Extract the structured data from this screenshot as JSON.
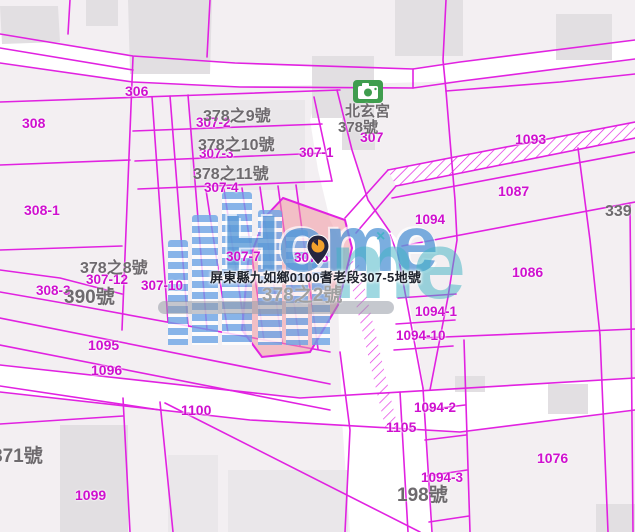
{
  "map": {
    "region_name": "九如鄉耆老段 cadastral map",
    "tooltip": {
      "text": "屏東縣九如鄉0100耆老段307-5地號"
    },
    "selected_parcel": {
      "number": "307-5",
      "fill": "#f098a2"
    },
    "parcel_labels": [
      {
        "text": "306",
        "x": 125,
        "y": 84,
        "size": 14
      },
      {
        "text": "308",
        "x": 22,
        "y": 116,
        "size": 14
      },
      {
        "text": "307-2",
        "x": 196,
        "y": 116
      },
      {
        "text": "307-3",
        "x": 199,
        "y": 147
      },
      {
        "text": "307-1",
        "x": 299,
        "y": 146
      },
      {
        "text": "307-4",
        "x": 204,
        "y": 181
      },
      {
        "text": "307",
        "x": 360,
        "y": 130,
        "size": 14
      },
      {
        "text": "308-1",
        "x": 24,
        "y": 203,
        "size": 14
      },
      {
        "text": "1093",
        "x": 515,
        "y": 132,
        "size": 14
      },
      {
        "text": "1087",
        "x": 498,
        "y": 184,
        "size": 14
      },
      {
        "text": "1094",
        "x": 415,
        "y": 213
      },
      {
        "text": "1086",
        "x": 512,
        "y": 265,
        "size": 14
      },
      {
        "text": "307-7",
        "x": 226,
        "y": 250
      },
      {
        "text": "307-5",
        "x": 294,
        "y": 251
      },
      {
        "text": "307-12",
        "x": 86,
        "y": 273
      },
      {
        "text": "308-3",
        "x": 36,
        "y": 284
      },
      {
        "text": "307-10",
        "x": 141,
        "y": 279
      },
      {
        "text": "1094-1",
        "x": 415,
        "y": 305
      },
      {
        "text": "1094-10",
        "x": 396,
        "y": 329
      },
      {
        "text": "1095",
        "x": 88,
        "y": 338,
        "size": 14
      },
      {
        "text": "1096",
        "x": 91,
        "y": 363,
        "size": 14
      },
      {
        "text": "1100",
        "x": 181,
        "y": 403,
        "size": 14
      },
      {
        "text": "1094-2",
        "x": 414,
        "y": 401
      },
      {
        "text": "1105",
        "x": 386,
        "y": 420,
        "size": 14
      },
      {
        "text": "1094-3",
        "x": 421,
        "y": 471
      },
      {
        "text": "1076",
        "x": 537,
        "y": 451,
        "size": 14
      },
      {
        "text": "1099",
        "x": 75,
        "y": 488,
        "size": 14
      }
    ],
    "address_labels": [
      {
        "text": "378之9號",
        "x": 203,
        "y": 109,
        "size": 16
      },
      {
        "text": "378之10號",
        "x": 198,
        "y": 138,
        "size": 16
      },
      {
        "text": "378之11號",
        "x": 193,
        "y": 167,
        "size": 16
      },
      {
        "text": "北玄宮",
        "x": 345,
        "y": 104,
        "size": 15
      },
      {
        "text": "378號",
        "x": 338,
        "y": 120,
        "size": 15
      },
      {
        "text": "378之8號",
        "x": 80,
        "y": 261,
        "size": 16
      },
      {
        "text": "390號",
        "x": 64,
        "y": 288,
        "size": 19
      },
      {
        "text": "378之2號",
        "x": 262,
        "y": 286,
        "size": 19,
        "color": "#a0a0a0"
      },
      {
        "text": "871號",
        "x": -8,
        "y": 447,
        "size": 19
      },
      {
        "text": "198號",
        "x": 397,
        "y": 486,
        "size": 19
      },
      {
        "text": "339",
        "x": 605,
        "y": 204,
        "size": 16
      }
    ],
    "icons": [
      {
        "name": "camera-icon",
        "meaning": "photo/temple point of interest"
      },
      {
        "name": "location-pin-icon",
        "meaning": "selected parcel marker"
      },
      {
        "name": "x-mark-icon",
        "meaning": "watermark sparkle"
      }
    ]
  },
  "watermark": {
    "home_text": "Home",
    "me_text": "me",
    "x_mark": "×"
  },
  "colors": {
    "line": "#e122e1",
    "label": "#cf10cf",
    "address": "#6e6a6e",
    "selected": "#f098a2",
    "road": "#ffffff",
    "parcel": "#f3eff2",
    "building": "#e2dfe2",
    "building2": "#eae7ea",
    "wmblue": "#5b9bd8",
    "wmteal": "#3fb3c4",
    "tooltip": "#20242e",
    "camera": "#3f9d4e",
    "pindark": "#262640",
    "pinorange": "#f2a12c"
  }
}
